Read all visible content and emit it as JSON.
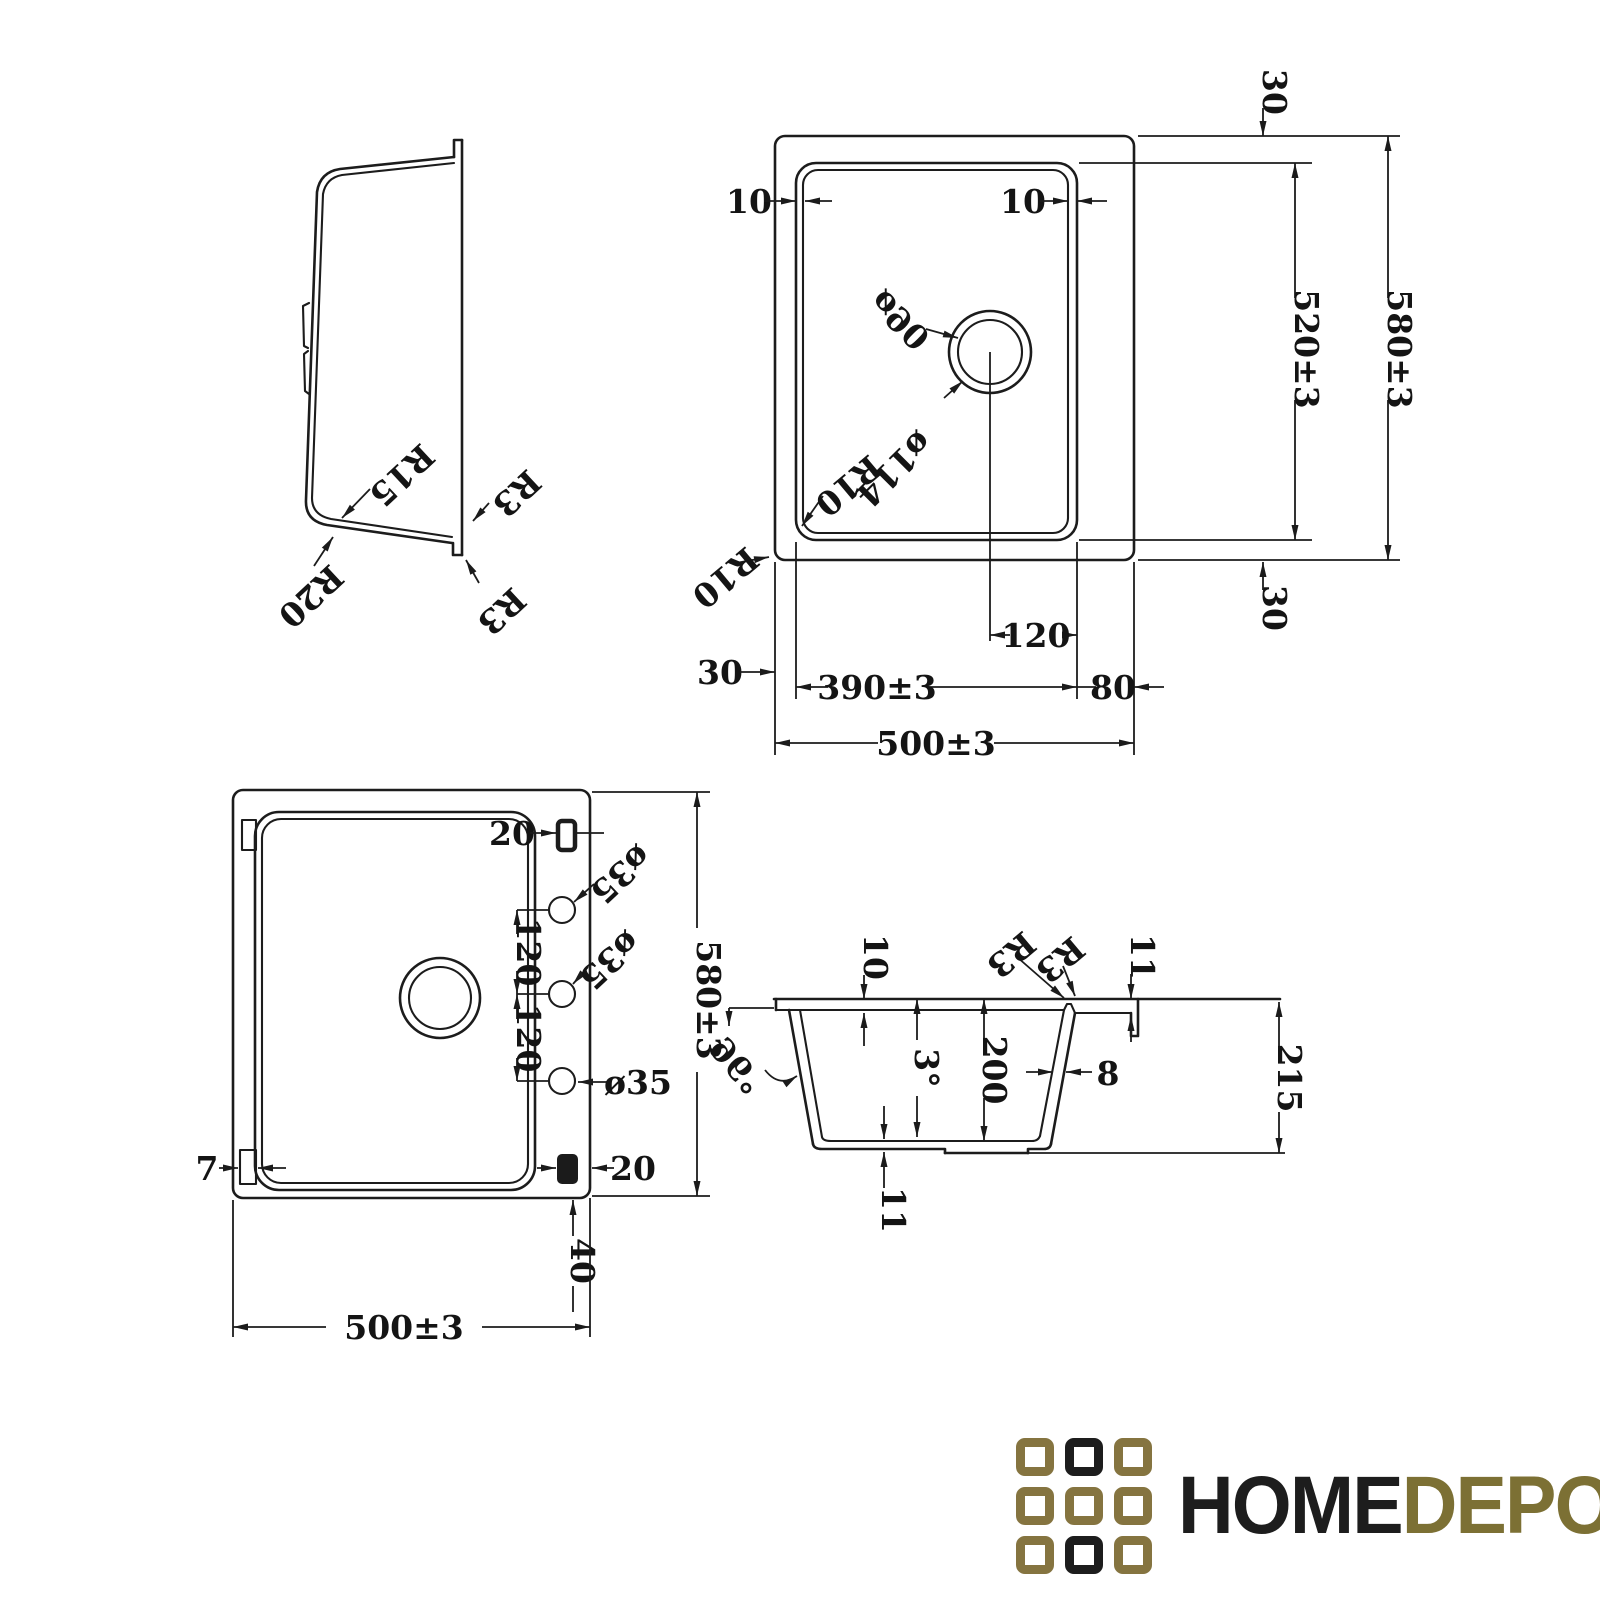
{
  "profile": {
    "r15": "R15",
    "r20": "R20",
    "r3_upper": "R3",
    "r3_lower": "R3"
  },
  "top": {
    "d10_left": "10",
    "d10_right": "10",
    "dia90": "ø90",
    "dia114": "ø114",
    "r10_bowl": "R10",
    "r10_outer": "R10",
    "d30_top": "30",
    "d520": "520±3",
    "d580": "580±3",
    "d30_bottom": "30",
    "d120": "120",
    "d390": "390±3",
    "d80": "80",
    "d30_left": "30",
    "d500": "500±3"
  },
  "bottom": {
    "d20_top": "20",
    "d20_bottom": "20",
    "d7": "7",
    "dia35_top": "ø35",
    "dia35_mid": "ø35",
    "dia35_low": "ø35",
    "d120_a": "120",
    "d120_b": "120",
    "d580": "580±3",
    "d40": "40",
    "d500": "500±3"
  },
  "section": {
    "d10": "10",
    "a96": "96°",
    "a3": "3°",
    "d200": "200",
    "d8": "8",
    "r3_inner": "R3",
    "r3_outer": "R3",
    "d11_top": "11",
    "d215": "215",
    "d11_bottom": "11"
  },
  "logo": {
    "home": "HOME",
    "depo": "DEPO",
    "colors": {
      "gold": "#857440",
      "black": "#1d1d1d"
    },
    "grid": [
      [
        "gold",
        "black",
        "gold"
      ],
      [
        "gold",
        "gold",
        "gold"
      ],
      [
        "gold",
        "black",
        "gold"
      ]
    ]
  }
}
